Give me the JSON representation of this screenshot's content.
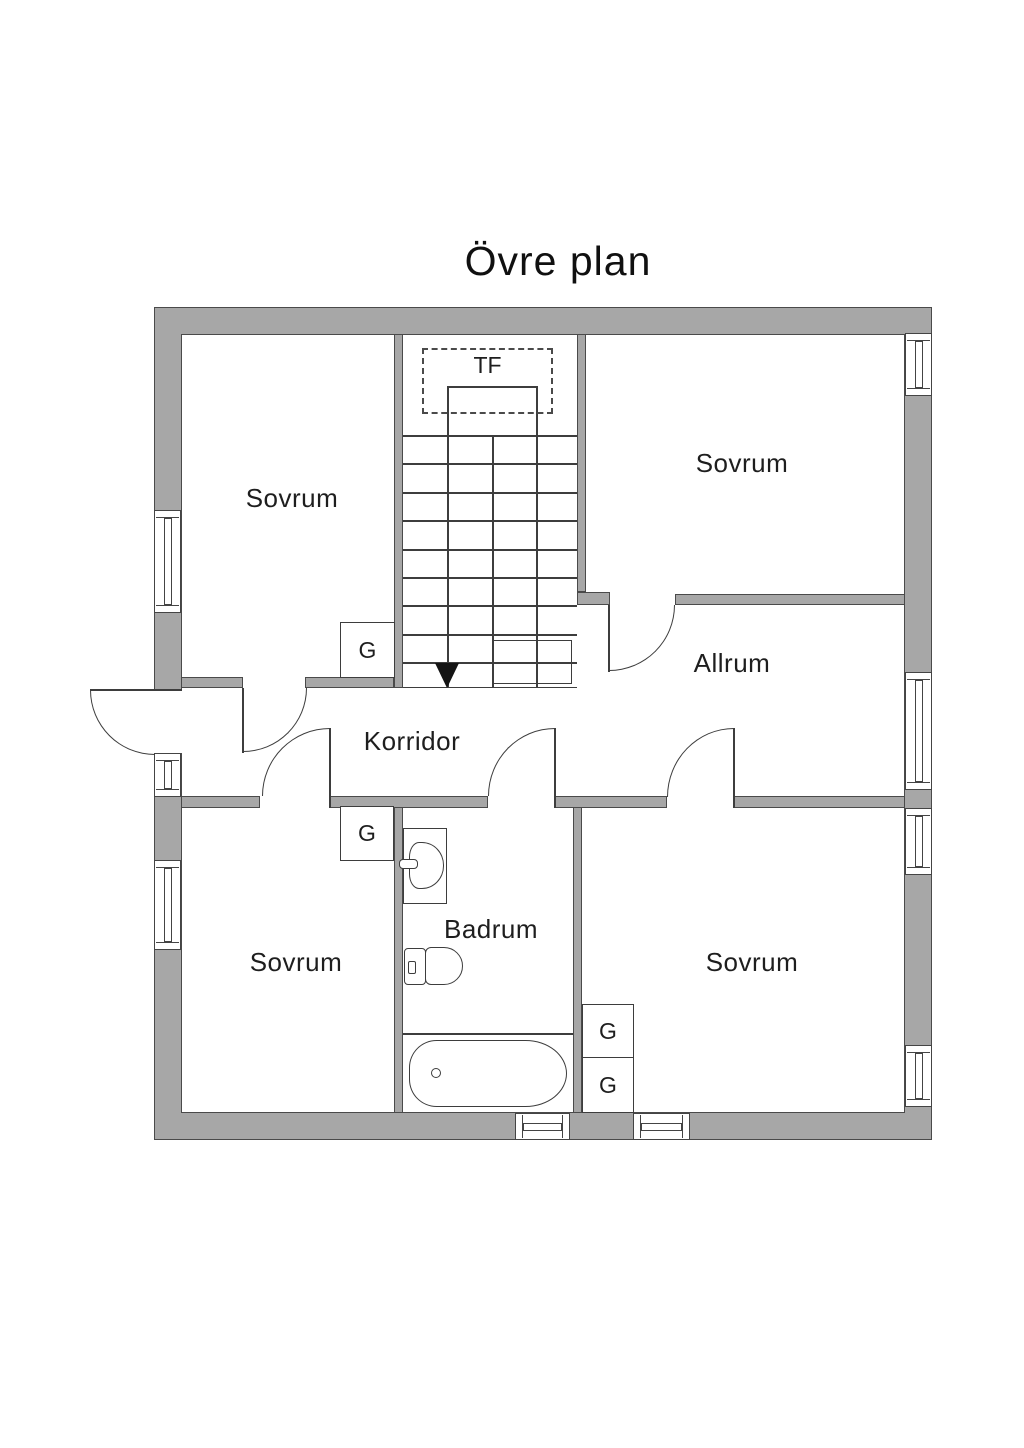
{
  "title": "Övre plan",
  "rooms": [
    {
      "name": "sovrum-top-left",
      "label": "Sovrum"
    },
    {
      "name": "sovrum-top-right",
      "label": "Sovrum"
    },
    {
      "name": "allrum",
      "label": "Allrum"
    },
    {
      "name": "korridor",
      "label": "Korridor"
    },
    {
      "name": "sovrum-bottom-left",
      "label": "Sovrum"
    },
    {
      "name": "badrum",
      "label": "Badrum"
    },
    {
      "name": "sovrum-bottom-right",
      "label": "Sovrum"
    }
  ],
  "stairs": {
    "attic_window_label": "TF",
    "direction": "down"
  },
  "closets": [
    {
      "label": "G"
    },
    {
      "label": "G"
    },
    {
      "label": "G"
    },
    {
      "label": "G"
    }
  ],
  "colors": {
    "wall_fill": "#a7a7a7",
    "line": "#3d3d3d",
    "text": "#1e1e1e"
  }
}
